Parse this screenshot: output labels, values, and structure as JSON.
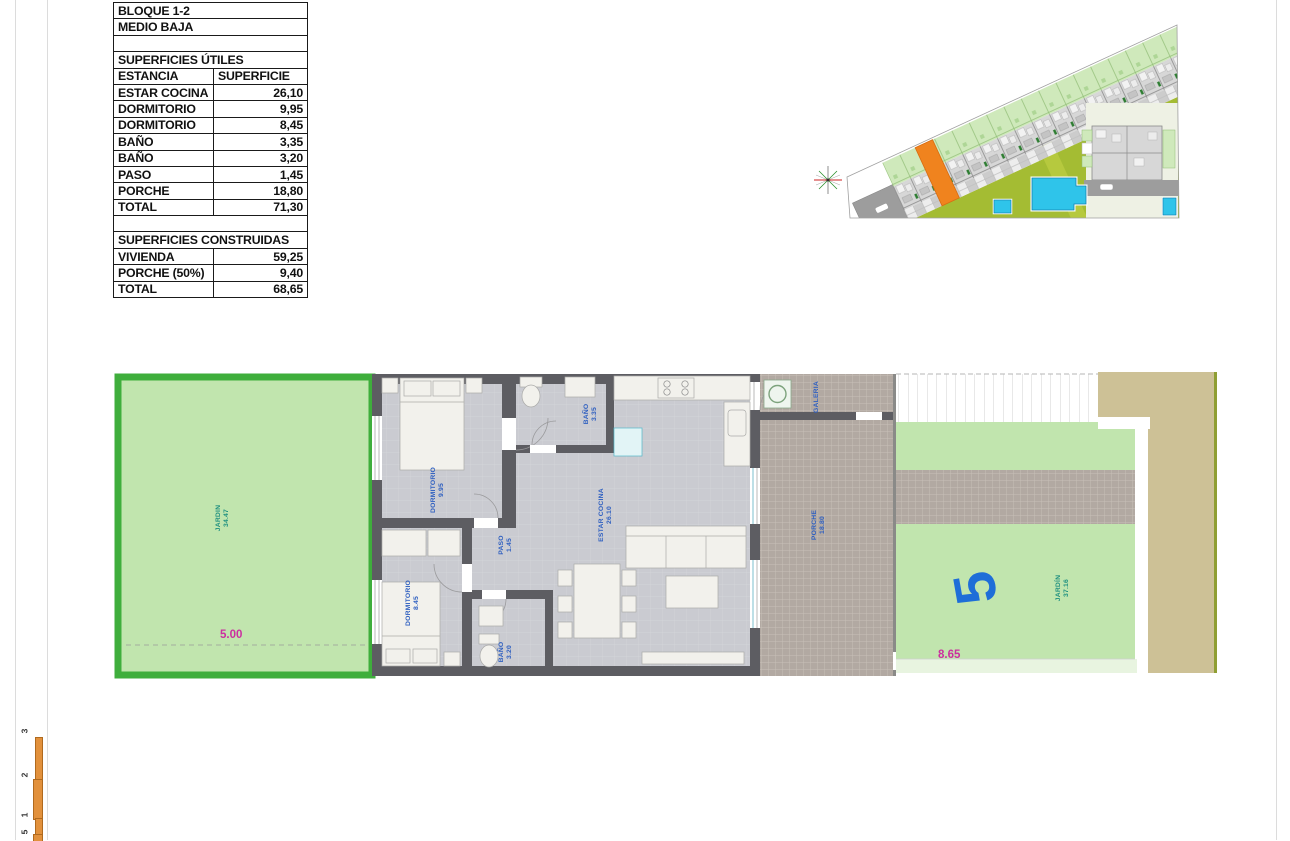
{
  "document": {
    "type": "floor-plan-sheet",
    "block_title": "BLOQUE 1-2",
    "level_title": "MEDIO BAJA"
  },
  "table": {
    "rows": [
      {
        "cells": [
          "BLOQUE 1-2"
        ]
      },
      {
        "cells": [
          "MEDIO BAJA"
        ]
      },
      {
        "cells": [
          ""
        ]
      },
      {
        "cells": [
          "SUPERFICIES ÚTILES"
        ]
      },
      {
        "cells": [
          "ESTANCIA",
          "SUPERFICIE"
        ],
        "header": true
      },
      {
        "cells": [
          "ESTAR COCINA",
          "26,10"
        ]
      },
      {
        "cells": [
          "DORMITORIO",
          "9,95"
        ]
      },
      {
        "cells": [
          "DORMITORIO",
          "8,45"
        ]
      },
      {
        "cells": [
          "BAÑO",
          "3,35"
        ]
      },
      {
        "cells": [
          "BAÑO",
          "3,20"
        ]
      },
      {
        "cells": [
          "PASO",
          "1,45"
        ]
      },
      {
        "cells": [
          "PORCHE",
          "18,80"
        ]
      },
      {
        "cells": [
          "TOTAL",
          "71,30"
        ]
      },
      {
        "cells": [
          ""
        ]
      },
      {
        "cells": [
          "SUPERFICIES CONSTRUIDAS"
        ]
      },
      {
        "cells": [
          "VIVIENDA",
          "59,25"
        ]
      },
      {
        "cells": [
          "PORCHE (50%)",
          "9,40"
        ]
      },
      {
        "cells": [
          "TOTAL",
          "68,65"
        ]
      }
    ]
  },
  "floor_plan": {
    "rooms": [
      {
        "name": "JARDIN",
        "area": "34.47"
      },
      {
        "name": "DORMITORIO",
        "area": "9.95"
      },
      {
        "name": "DORMITORIO",
        "area": "8.45"
      },
      {
        "name": "BAÑO",
        "area": "3.35"
      },
      {
        "name": "BAÑO",
        "area": "3.20"
      },
      {
        "name": "PASO",
        "area": "1.45"
      },
      {
        "name": "ESTAR COCINA",
        "area": "26.10"
      },
      {
        "name": "PORCHE",
        "area": "18.80"
      },
      {
        "name": "GALERIA",
        "area": ""
      },
      {
        "name": "JARDÍN",
        "area": "37.16"
      }
    ],
    "dimensions": {
      "garden_left": "5.00",
      "garden_right": "8.65"
    },
    "unit_number": "5"
  },
  "scale_bar": {
    "labels": [
      "3",
      "2",
      "1",
      "5"
    ]
  },
  "colors": {
    "garden_border": "#3fae3c",
    "garden_fill": "#c1e5ae",
    "wall": "#5d5d62",
    "floor": "#cacbd1",
    "tile": "#b2a9a2",
    "path_tan": "#cdc196",
    "olive_edge": "#8f9e33",
    "room_label_blue": "#2e5fc0",
    "garden_label_teal": "#1f9080",
    "dimension_magenta": "#cc2fa0",
    "unit_number_blue": "#1e6ed8",
    "site_lawn": "#a4bc33",
    "site_garden_cells": "#cfe9bb",
    "pool_blue": "#2fc4ea",
    "highlight_orange": "#f0831e",
    "scale_bar_orange": "#e2913c"
  }
}
